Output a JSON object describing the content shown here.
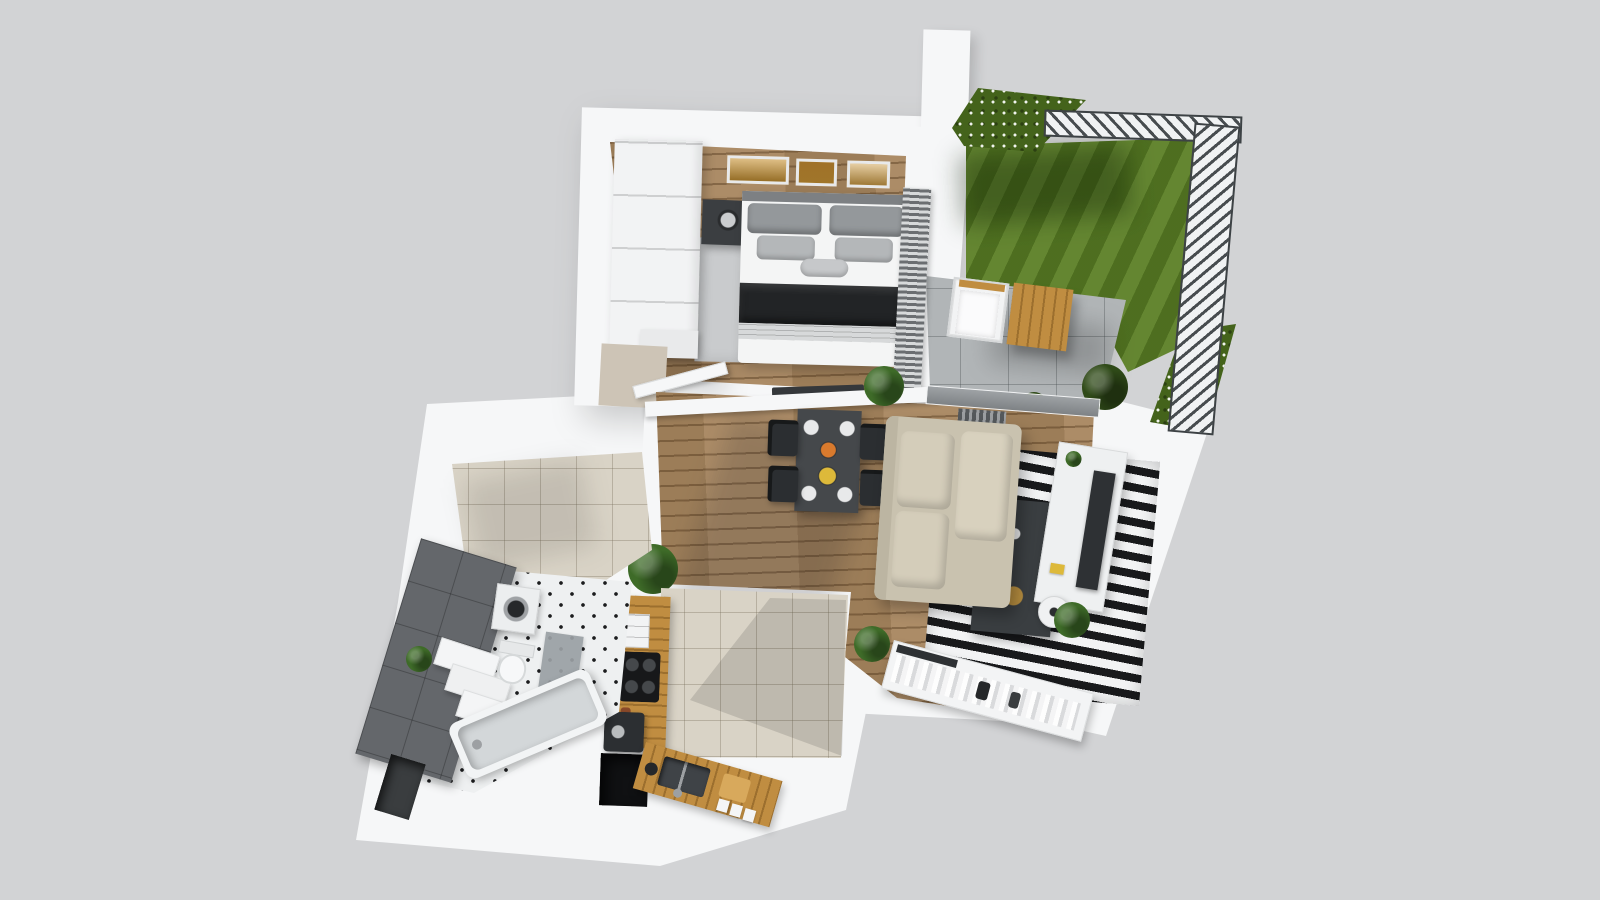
{
  "scene": {
    "type": "photorealistic-3d-floor-plan-render",
    "view": "top-down",
    "visible_text": "none"
  },
  "colors": {
    "background": "#d2d3d5",
    "wall": "#f6f7f8",
    "wall_inner_tan": "#cdc4b6",
    "wood_floor": "#a8865f",
    "tile_floor": "#d9d3c6",
    "grass": "#5c8026",
    "hedge": "#44631b",
    "terrace_paver": "#b1b5b7",
    "fence_dark": "#42474a",
    "bath_wall_tile": "#64676b",
    "bath_floor": "#eef0f1",
    "bedroom_rug": "#c9cbcd",
    "stripe_rug_dark": "#191a1c",
    "stripe_rug_light": "#f2f3f4",
    "sofa": "#c9c2af",
    "dining_table": "#45484b",
    "chair": "#2b2e31",
    "coffee_table": "#3a3e41",
    "tv": "#2e3134",
    "counter_wood": "#c08d41",
    "dark_niche": "#101113",
    "plant_green": "#3e6b28",
    "bush_green": "#2f4a18",
    "bed_throw": "#222426",
    "pillow_gray": "#94989b",
    "picture_gold": "#c89334",
    "food_orange": "#d97a2d",
    "food_yellow": "#ddb93a",
    "appliance_dark": "#2c2f32",
    "mat_gray": "#9aa0a4"
  },
  "plan": {
    "rooms": [
      {
        "name": "bedroom",
        "floor": "wood-planks",
        "items": [
          "white-wardrobe",
          "double-bed",
          "gray-pillows",
          "dark-throw-blanket",
          "nightstand-left",
          "nightstand-right",
          "table-lamps",
          "three-framed-pictures",
          "gray-rug",
          "wall-radiator",
          "potted-plant",
          "open-door"
        ]
      },
      {
        "name": "living-dining-room",
        "floor": "wood-planks",
        "items": [
          "dark-dining-table",
          "four-black-chairs",
          "set-plates-and-food",
          "beige-l-shaped-sofa",
          "black-white-striped-rug",
          "dark-coffee-table",
          "gold-bowl",
          "white-sideboard",
          "flat-tv",
          "round-stool",
          "open-clothes-rack",
          "house-plants",
          "terrace-sliding-door"
        ]
      },
      {
        "name": "kitchen",
        "floor": "beige-tile",
        "items": [
          "wood-counter-left",
          "induction-cooktop",
          "white-shelf-unit",
          "coffee-machine",
          "dark-appliance-niche",
          "wood-counter-bottom",
          "double-sink",
          "faucet",
          "cutting-board",
          "white-canisters"
        ]
      },
      {
        "name": "bathroom",
        "floor": "white-tile-black-diamonds",
        "items": [
          "dark-gray-tiled-wall",
          "stepped-vanity",
          "toilet",
          "washing-machine",
          "bathtub",
          "gray-bath-mat",
          "small-plant",
          "wall-niche"
        ]
      },
      {
        "name": "entry-hall",
        "floor": "beige-tile",
        "items": [
          "open-door-leaf"
        ]
      },
      {
        "name": "terrace",
        "floor": "concrete-pavers",
        "items": [
          "white-lounge-chair",
          "wooden-table",
          "bushes"
        ]
      },
      {
        "name": "garden",
        "floor": "lawn-grass",
        "items": [
          "flowering-hedge-top",
          "flowering-hedge-corner",
          "metal-slat-fence-top",
          "metal-slat-fence-right"
        ]
      }
    ]
  }
}
